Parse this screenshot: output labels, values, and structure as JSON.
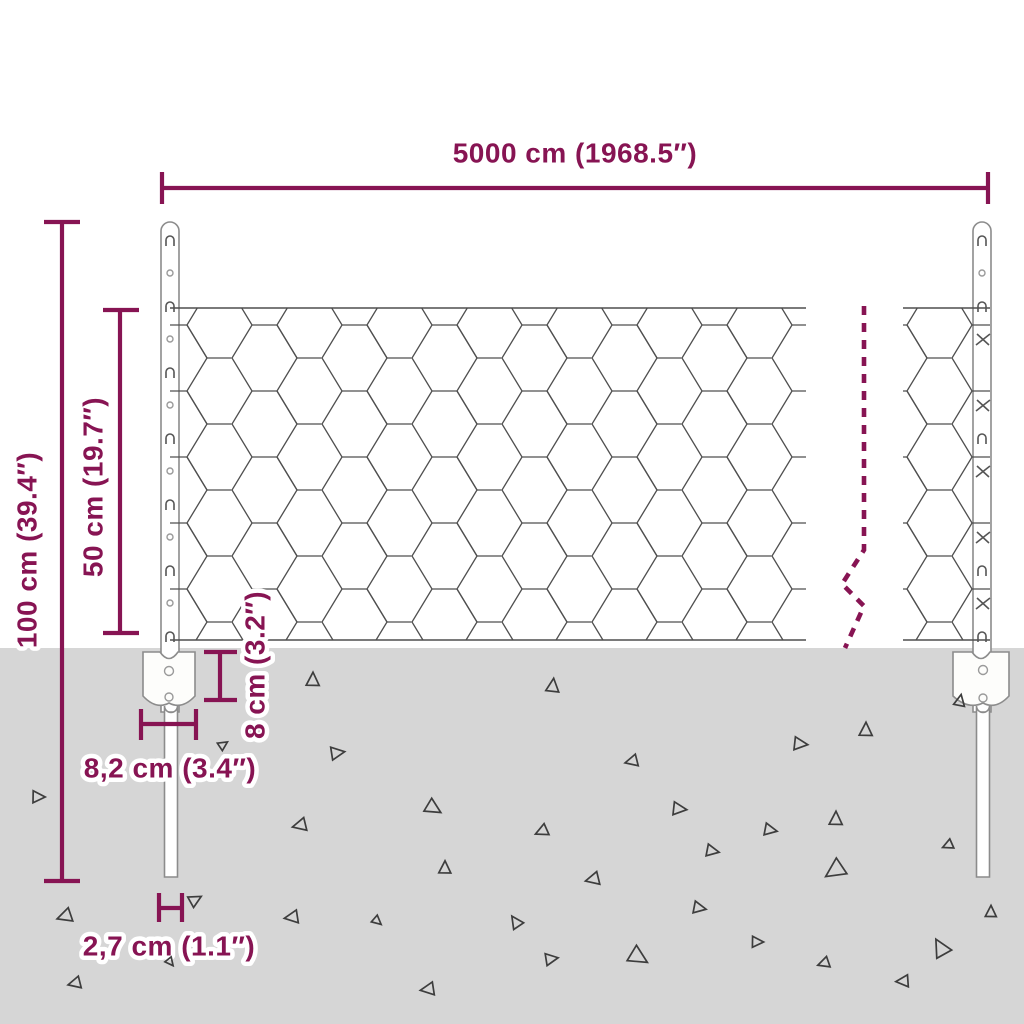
{
  "title": "Wire mesh fence dimension diagram",
  "colors": {
    "accent": "#871453",
    "ground": "#d6d6d6",
    "wire": "#4f4f4f",
    "post": "#8c8c8c"
  },
  "dimensions": {
    "total_width": {
      "label": "5000 cm (1968.5″)"
    },
    "post_height": {
      "label": "100 cm (39.4″)"
    },
    "mesh_height": {
      "label": "50 cm (19.7″)"
    },
    "anchor_height": {
      "label": "8 cm (3.2″)"
    },
    "anchor_width": {
      "label": "8,2 cm (3.4″)"
    },
    "post_width": {
      "label": "2,7 cm (1.1″)"
    }
  },
  "ground_triangles": [
    {
      "x": 313,
      "y": 680,
      "s": 13,
      "r": 0
    },
    {
      "x": 553,
      "y": 686,
      "s": 13,
      "r": 5
    },
    {
      "x": 960,
      "y": 701,
      "s": 11,
      "r": 10
    },
    {
      "x": 866,
      "y": 730,
      "s": 13,
      "r": 0
    },
    {
      "x": 800,
      "y": 744,
      "s": 13,
      "r": 95
    },
    {
      "x": 337,
      "y": 753,
      "s": 13,
      "r": 80
    },
    {
      "x": 632,
      "y": 761,
      "s": 12,
      "r": 255
    },
    {
      "x": 38,
      "y": 797,
      "s": 12,
      "r": 90
    },
    {
      "x": 679,
      "y": 809,
      "s": 13,
      "r": 95
    },
    {
      "x": 433,
      "y": 808,
      "s": 15,
      "r": 120
    },
    {
      "x": 300,
      "y": 825,
      "s": 13,
      "r": 255
    },
    {
      "x": 836,
      "y": 819,
      "s": 13,
      "r": 0
    },
    {
      "x": 770,
      "y": 830,
      "s": 12,
      "r": 100
    },
    {
      "x": 542,
      "y": 831,
      "s": 12,
      "r": 245
    },
    {
      "x": 445,
      "y": 868,
      "s": 12,
      "r": 0
    },
    {
      "x": 712,
      "y": 851,
      "s": 12,
      "r": 100
    },
    {
      "x": 593,
      "y": 879,
      "s": 13,
      "r": 255
    },
    {
      "x": 835,
      "y": 870,
      "s": 19,
      "r": 235
    },
    {
      "x": 948,
      "y": 845,
      "s": 10,
      "r": 245
    },
    {
      "x": 516,
      "y": 922,
      "s": 12,
      "r": 325
    },
    {
      "x": 699,
      "y": 908,
      "s": 12,
      "r": 100
    },
    {
      "x": 65,
      "y": 916,
      "s": 14,
      "r": 250
    },
    {
      "x": 195,
      "y": 900,
      "s": 12,
      "r": 60
    },
    {
      "x": 292,
      "y": 917,
      "s": 13,
      "r": 260
    },
    {
      "x": 377,
      "y": 921,
      "s": 9,
      "r": 130
    },
    {
      "x": 551,
      "y": 959,
      "s": 12,
      "r": 80
    },
    {
      "x": 638,
      "y": 957,
      "s": 18,
      "r": 120
    },
    {
      "x": 757,
      "y": 942,
      "s": 11,
      "r": 90
    },
    {
      "x": 824,
      "y": 963,
      "s": 11,
      "r": 250
    },
    {
      "x": 903,
      "y": 981,
      "s": 12,
      "r": 265
    },
    {
      "x": 941,
      "y": 948,
      "s": 17,
      "r": 330
    },
    {
      "x": 991,
      "y": 912,
      "s": 11,
      "r": 0
    },
    {
      "x": 75,
      "y": 983,
      "s": 12,
      "r": 255
    },
    {
      "x": 428,
      "y": 989,
      "s": 13,
      "r": 260
    },
    {
      "x": 170,
      "y": 962,
      "s": 8,
      "r": 140
    },
    {
      "x": 223,
      "y": 745,
      "s": 9,
      "r": 55
    }
  ]
}
